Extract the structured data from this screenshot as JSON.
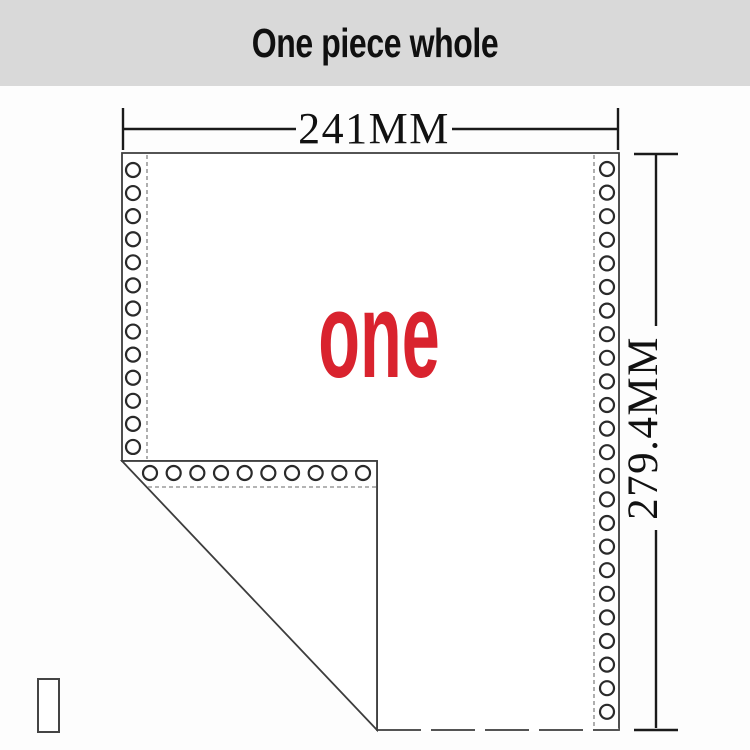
{
  "header": {
    "title": "One piece whole",
    "background_color": "#d9d9d9",
    "text_color": "#101010"
  },
  "diagram": {
    "width_label": "241MM",
    "height_label": "279.4MM",
    "center_label": "one",
    "center_label_color": "#d9232e",
    "line_color": "#1a1a1a",
    "paper_edge_color": "#3d3d3d",
    "perforation_dash_color": "#9b9b9b",
    "holes": {
      "left_count": 13,
      "right_count": 24,
      "bottom_count": 10
    }
  }
}
